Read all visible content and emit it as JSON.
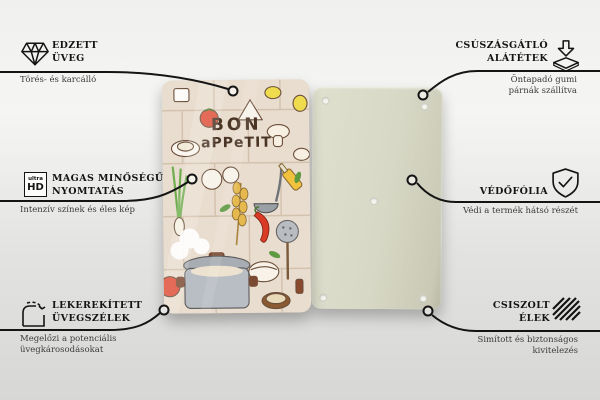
{
  "product": {
    "front_title_line1": "BON",
    "front_title_line2": "aPPeTIT"
  },
  "callouts": {
    "left": [
      {
        "title": "EDZETT ÜVEG",
        "description": "Törés- és karcálló",
        "icon": "diamond-icon"
      },
      {
        "title": "MAGAS MINŐSÉGŰ NYOMTATÁS",
        "description": "Intenzív színek és éles kép",
        "icon": "ultra-hd-icon",
        "icon_text_top": "ultra",
        "icon_text_bottom": "HD"
      },
      {
        "title": "LEKEREKÍTETT ÜVEGSZÉLEK",
        "description": "Megelőzi a potenciális üvegkárosodásokat",
        "icon": "rounded-corner-icon"
      }
    ],
    "right": [
      {
        "title": "CSÚSZÁSGÁTLÓ ALÁTÉTEK",
        "description": "Öntapadó gumi párnák szállítva",
        "icon": "anti-slip-pad-icon"
      },
      {
        "title": "VÉDŐFÓLIA",
        "description": "Védi a termék hátsó részét",
        "icon": "shield-check-icon"
      },
      {
        "title": "CSISZOLT ÉLEK",
        "description": "Simított és biztonságos kivitelezés",
        "icon": "polished-edge-icon"
      }
    ]
  },
  "colors": {
    "background_top": "#f0f0ee",
    "background_bottom": "#d7d7d5",
    "callout_line": "#141414",
    "title_text": "#141414",
    "description_text": "#3b3b3b",
    "front_board_bg": "#e9ddcf",
    "front_board_tile_line": "#d3c2ae",
    "front_board_title_text": "#4a3424",
    "back_board": "#d8d8c6",
    "tomato_red": "#df4f38",
    "chili_red": "#d93b25",
    "lemon_yellow": "#eedc4e",
    "onion_green": "#6fae4e",
    "wheat_gold": "#e5b94e",
    "pot_gray": "#b9bec4"
  }
}
